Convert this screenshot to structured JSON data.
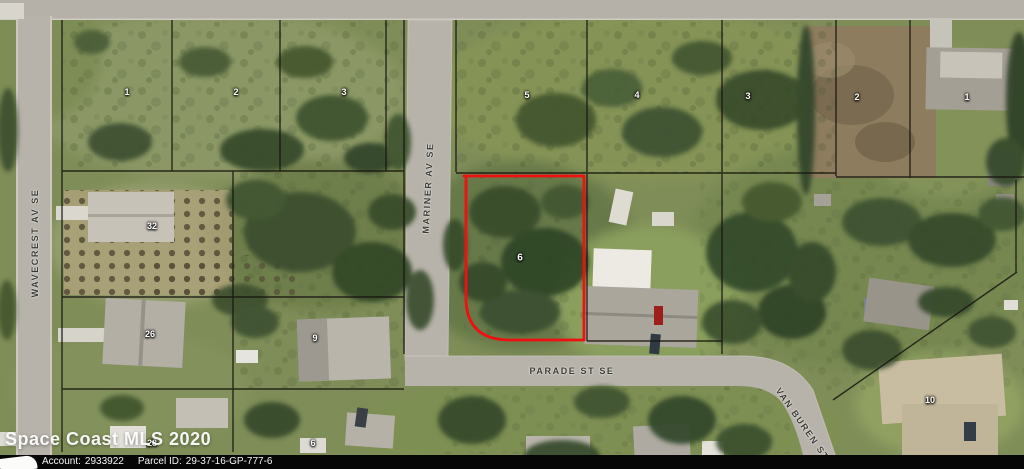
{
  "map": {
    "watermark": "Space Coast MLS 2020",
    "provider_bar": {
      "account_label": "Account:",
      "account_value": "2933922",
      "parcel_label": "Parcel ID:",
      "parcel_value": "29-37-16-GP-777-6"
    },
    "highlight_color": "#ef1010",
    "streets": [
      {
        "id": "wavecrest",
        "name": "WAVECREST AV SE",
        "x": 35,
        "y": 243,
        "rotate": -90
      },
      {
        "id": "mariner",
        "name": "MARINER AV SE",
        "x": 428,
        "y": 188,
        "rotate": -87
      },
      {
        "id": "parade",
        "name": "PARADE ST SE",
        "x": 572,
        "y": 371,
        "rotate": 0
      },
      {
        "id": "van-buren",
        "name": "VAN BUREN ST SE",
        "x": 808,
        "y": 432,
        "rotate": 55
      }
    ],
    "parcel_numbers": [
      {
        "value": "1",
        "x": 127,
        "y": 92
      },
      {
        "value": "2",
        "x": 236,
        "y": 92
      },
      {
        "value": "3",
        "x": 344,
        "y": 92
      },
      {
        "value": "5",
        "x": 527,
        "y": 95
      },
      {
        "value": "4",
        "x": 637,
        "y": 95
      },
      {
        "value": "3",
        "x": 748,
        "y": 96
      },
      {
        "value": "2",
        "x": 857,
        "y": 97
      },
      {
        "value": "1",
        "x": 967,
        "y": 97
      },
      {
        "value": "32",
        "x": 152,
        "y": 226
      },
      {
        "value": "26",
        "x": 150,
        "y": 334
      },
      {
        "value": "9",
        "x": 315,
        "y": 338
      },
      {
        "value": "28",
        "x": 152,
        "y": 443
      },
      {
        "value": "6",
        "x": 313,
        "y": 443
      },
      {
        "value": "6",
        "x": 520,
        "y": 258,
        "highlight": true
      },
      {
        "value": "10",
        "x": 930,
        "y": 400
      }
    ]
  }
}
